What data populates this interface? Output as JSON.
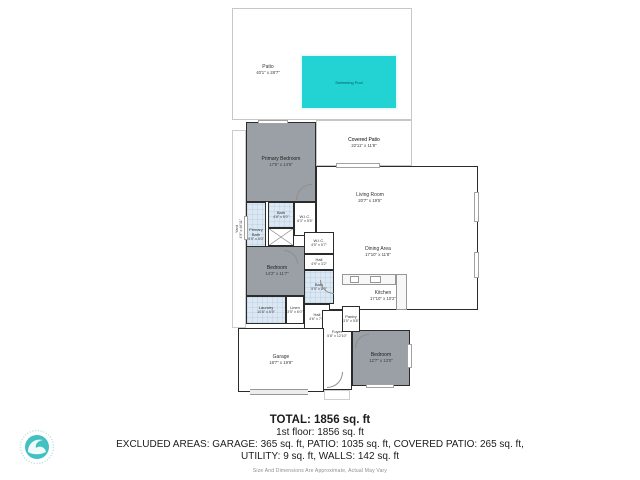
{
  "outdoor": {
    "patio": {
      "name": "Patio",
      "dims": "40'1\" x 28'7\""
    },
    "pool": {
      "name": "Swimming Pool"
    },
    "covered_patio": {
      "name": "Covered Patio",
      "dims": "22'11\" x 11'8\""
    },
    "yard": {
      "name": "Yard",
      "dims": "4'9\" x 46'11\""
    }
  },
  "rooms": {
    "primary_bedroom": {
      "name": "Primary Bedroom",
      "dims": "17'5\" x 14'6\""
    },
    "living_room": {
      "name": "Living Room",
      "dims": "20'7\" x 19'5\""
    },
    "dining_area": {
      "name": "Dining Area",
      "dims": "17'10\" x 11'8\""
    },
    "kitchen": {
      "name": "Kitchen",
      "dims": "17'10\" x 10'2\""
    },
    "primary_bath": {
      "name": "Primary Bath",
      "dims": "9'9\" x 5'0\""
    },
    "bath_top": {
      "name": "Bath",
      "dims": "4'8\" x 5'0\""
    },
    "wic_top": {
      "name": "W.I.C.",
      "dims": "8'3\" x 5'5\""
    },
    "bedroom_mid": {
      "name": "Bedroom",
      "dims": "14'2\" x 11'7\""
    },
    "wic_small": {
      "name": "W.I.C.",
      "dims": "4'5\" x 5'7\""
    },
    "hall_upper": {
      "name": "Hall",
      "dims": "4'9\" x 3'2\""
    },
    "bath_mid": {
      "name": "Bath",
      "dims": "5'5\" x 8'9\""
    },
    "laundry": {
      "name": "Laundry",
      "dims": "10'8\" x 6'9\""
    },
    "linen": {
      "name": "Linen",
      "dims": "3'5\" x 6'0\""
    },
    "hall_lower": {
      "name": "Hall",
      "dims": "4'6\" x 7'8\""
    },
    "pantry": {
      "name": "Pantry",
      "dims": "3'0\" x 5'8\""
    },
    "foyer": {
      "name": "Foyer",
      "dims": "5'8\" x 12'10\""
    },
    "garage": {
      "name": "Garage",
      "dims": "18'7\" x 19'8\""
    },
    "bedroom_back": {
      "name": "Bedroom",
      "dims": "12'7\" x 13'0\""
    }
  },
  "footer": {
    "total": "TOTAL: 1856 sq. ft",
    "first_floor": "1st floor: 1856 sq. ft",
    "excluded_line1": "EXCLUDED AREAS: GARAGE: 365 sq. ft, PATIO: 1035 sq. ft, COVERED PATIO: 265 sq. ft,",
    "excluded_line2": "UTILITY: 9 sq. ft, WALLS: 142 sq. ft",
    "disclaimer": "Size And Dimensions Are Approximate, Actual May Vary"
  },
  "colors": {
    "pool": "#23d2d2",
    "room_gray": "#9aa0a5",
    "bath_blue": "#dbe8f4",
    "wall": "#2b2b2b",
    "logo_teal": "#42c0c2"
  }
}
